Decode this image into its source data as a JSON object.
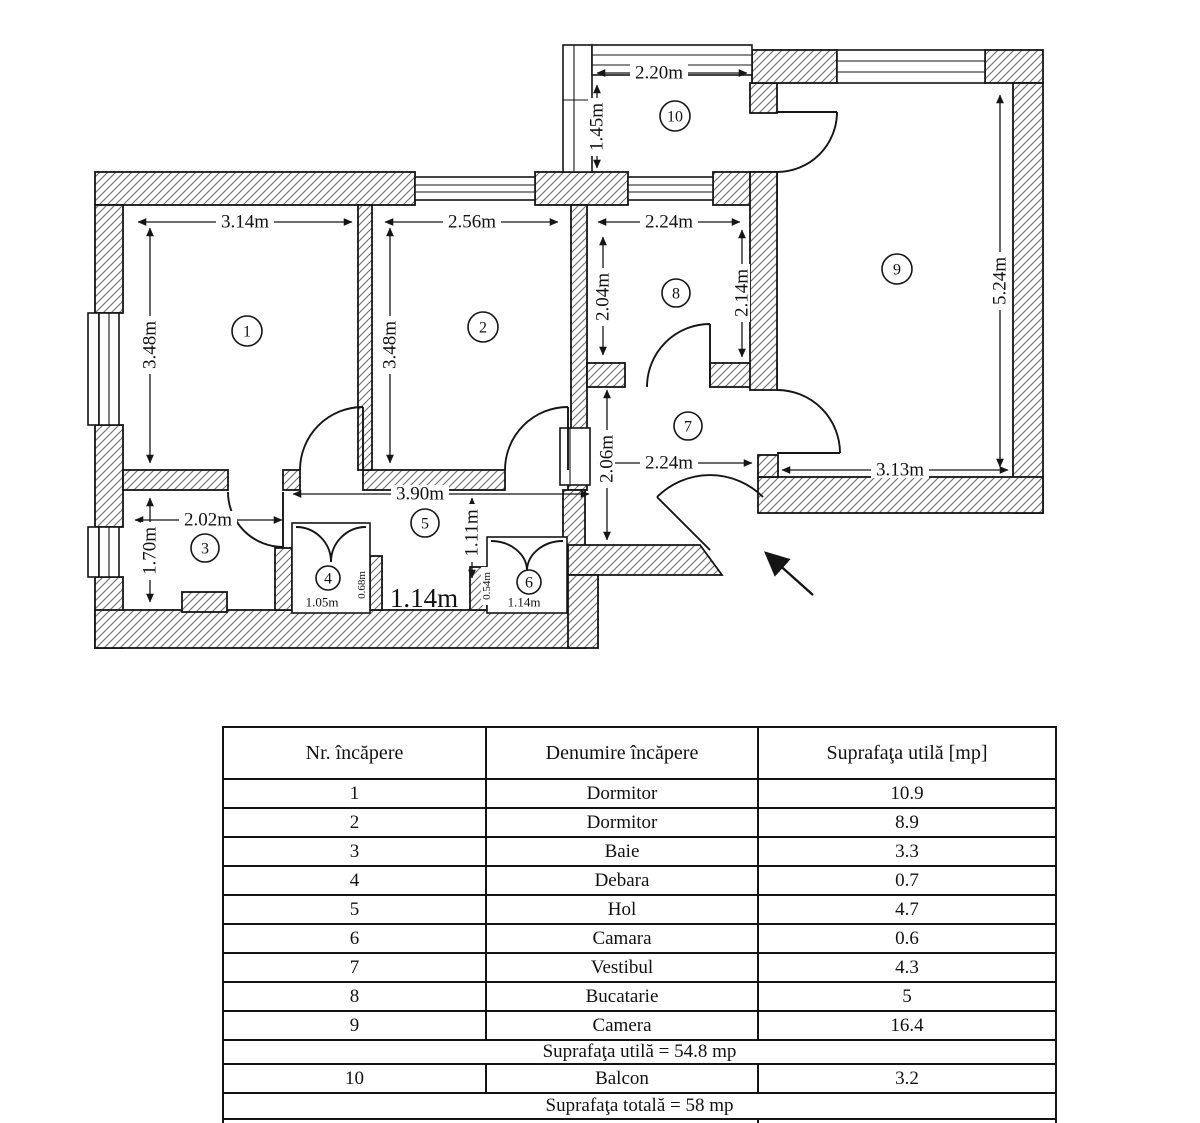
{
  "floorplan": {
    "rooms": [
      "1",
      "2",
      "3",
      "4",
      "5",
      "6",
      "7",
      "8",
      "9",
      "10"
    ],
    "dims": {
      "balcony_width": "2.20m",
      "balcony_depth": "1.45m",
      "room1_width": "3.14m",
      "room1_height": "3.48m",
      "room2_width": "2.56m",
      "room2_height": "3.48m",
      "room8_width": "2.24m",
      "room8_left_height": "2.04m",
      "room8_right_height": "2.14m",
      "room9_height": "5.24m",
      "room9_width": "3.13m",
      "room7_width": "2.24m",
      "room7_height": "2.06m",
      "room3_width": "2.02m",
      "room3_height": "1.70m",
      "hall_width": "3.90m",
      "hall_height": "1.11m",
      "room4_width": "1.05m",
      "room4_depth": "0.68m",
      "passage_width": "1.14m",
      "room6_width": "1.14m",
      "room6_depth": "0.54m"
    }
  },
  "table": {
    "headers": [
      "Nr. încăpere",
      "Denumire încăpere",
      "Suprafaţa utilă [mp]"
    ],
    "rows": [
      {
        "nr": "1",
        "name": "Dormitor",
        "area": "10.9"
      },
      {
        "nr": "2",
        "name": "Dormitor",
        "area": "8.9"
      },
      {
        "nr": "3",
        "name": "Baie",
        "area": "3.3"
      },
      {
        "nr": "4",
        "name": "Debara",
        "area": "0.7"
      },
      {
        "nr": "5",
        "name": "Hol",
        "area": "4.7"
      },
      {
        "nr": "6",
        "name": "Camara",
        "area": "0.6"
      },
      {
        "nr": "7",
        "name": "Vestibul",
        "area": "4.3"
      },
      {
        "nr": "8",
        "name": "Bucatarie",
        "area": "5"
      },
      {
        "nr": "9",
        "name": "Camera",
        "area": "16.4"
      }
    ],
    "subtotal_label": "Suprafaţa utilă = 54.8 mp",
    "balcony_row": {
      "nr": "10",
      "name": "Balcon",
      "area": "3.2"
    },
    "total_label": "Suprafaţa totală = 58 mp"
  }
}
